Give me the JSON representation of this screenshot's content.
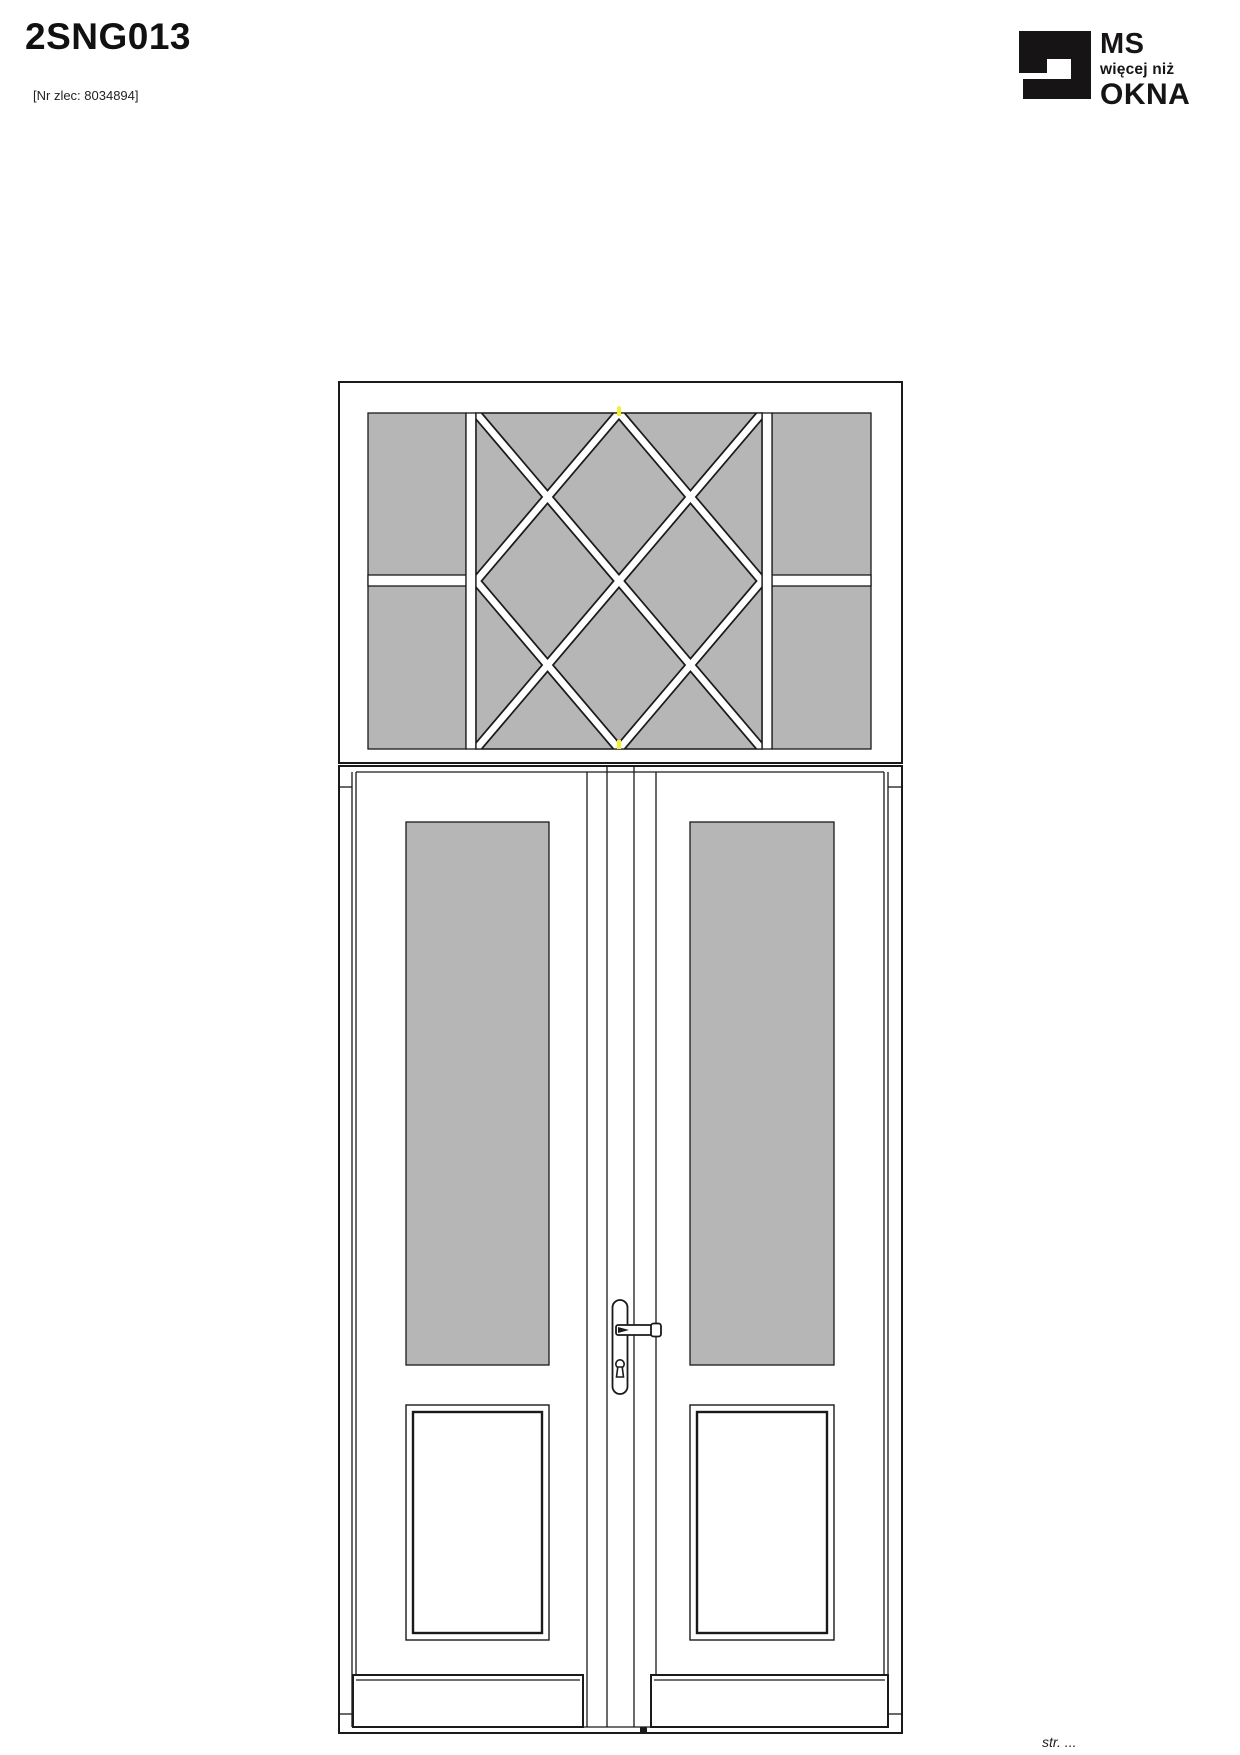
{
  "header": {
    "title": "2SNG013",
    "order_number": "[Nr zlec: 8034894]"
  },
  "logo": {
    "alt": "MS więcej niż OKNA",
    "line1": "MS",
    "line2": "więcej niż",
    "line3": "OKNA"
  },
  "footer": {
    "page_label": "str. ..."
  },
  "drawing": {
    "description": "Front elevation of a double french door with a transom window; transom has two side lights split by a horizontal glazing bar and a centre sash with diamond lattice glazing bars; each door leaf has a tall glass panel above a raised bottom panel; lever handle with long backplate and keyhole at the meeting stiles; kick rails at the bottom",
    "join_markers": "yellow ticks at top and bottom centre of transom lattice",
    "colors": {
      "glass": "#b6b6b6",
      "frame_fill": "#ffffff",
      "outline": "#1a1a1a",
      "join_marker": "#f2ef35"
    }
  }
}
